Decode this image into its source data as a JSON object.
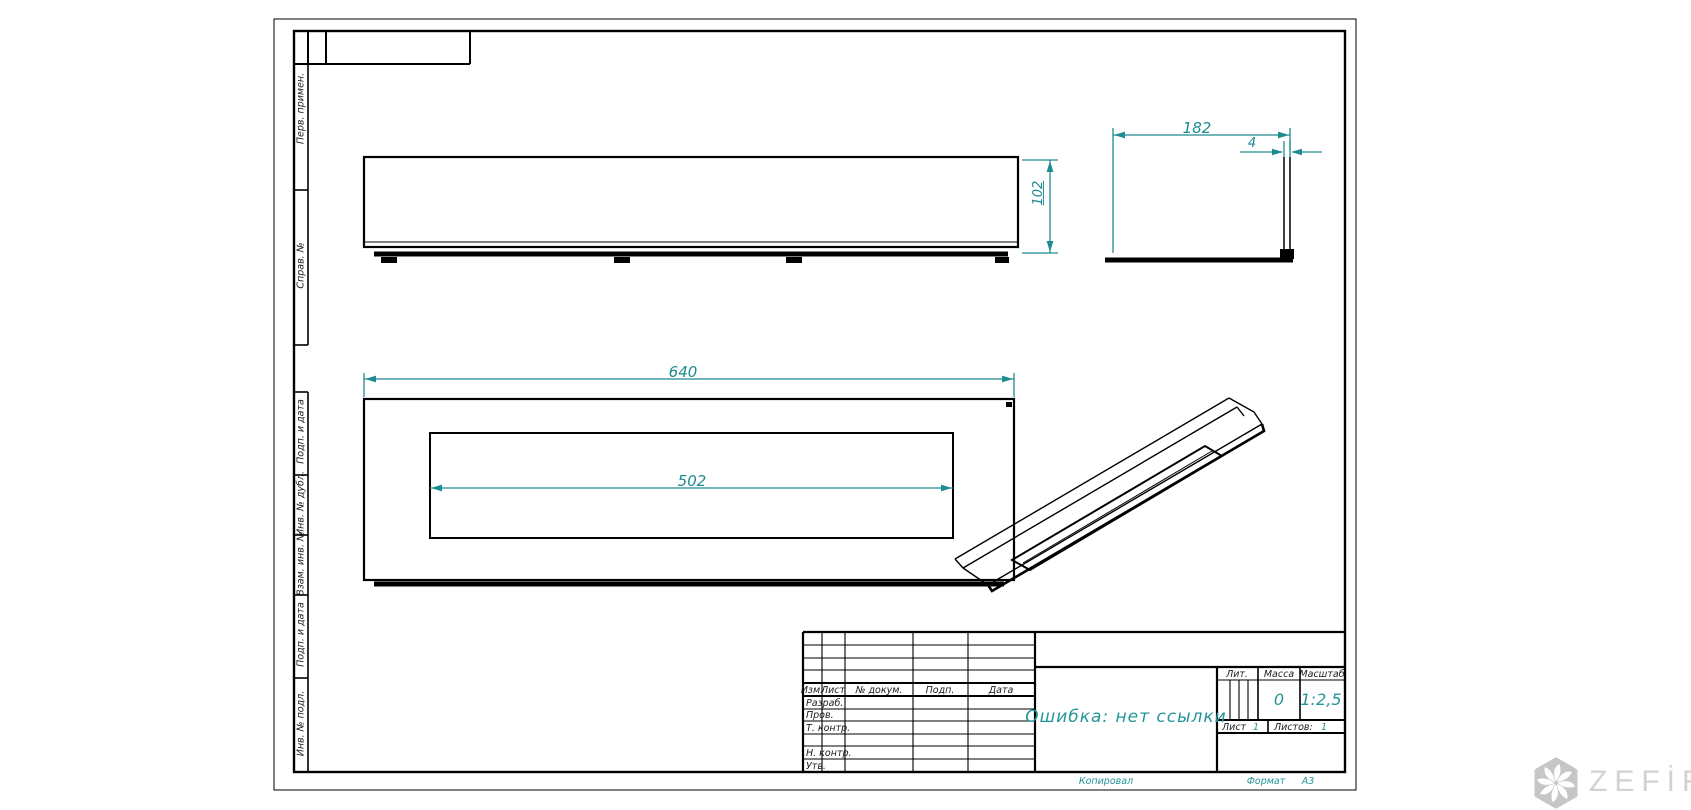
{
  "drawing": {
    "type_note": "GOST engineering drawing sheet, A3 landscape",
    "error_text": "Ошибка: нет ссылки",
    "dims": {
      "width": "640",
      "opening": "502",
      "depth": "182",
      "wall": "4",
      "height": "102"
    }
  },
  "left_margin": {
    "upper": [
      "Перв. примен.",
      "Справ. №"
    ],
    "lower": [
      "Подп. и дата",
      "Инв. № дубл.",
      "Взам. инв. №",
      "Подп. и дата",
      "Инв. № подл."
    ]
  },
  "title_block": {
    "header_cols": [
      "Изм.",
      "Лист",
      "№ докум.",
      "Подп.",
      "Дата"
    ],
    "rows": [
      "Разраб.",
      "Пров.",
      "Т. контр.",
      "",
      "Н. контр.",
      "Утв."
    ],
    "lit_label": "Лит.",
    "mass_label": "Масса",
    "scale_label": "Масштаб",
    "mass_value": "0",
    "scale_value": "1:2,5",
    "sheet_label": "Лист",
    "sheet_value": "1",
    "sheets_label": "Листов:",
    "sheets_value": "1",
    "kopiroval": "Копировал",
    "format_label": "Формат",
    "format_value": "А3"
  },
  "watermark": {
    "text": "ZEFİRE"
  },
  "colors": {
    "line": "#000000",
    "dimension": "#1d8b90",
    "accent_text": "#239598",
    "watermark_gray": "#d2d2d2",
    "logo_hex_gray": "#c6c6c6"
  }
}
